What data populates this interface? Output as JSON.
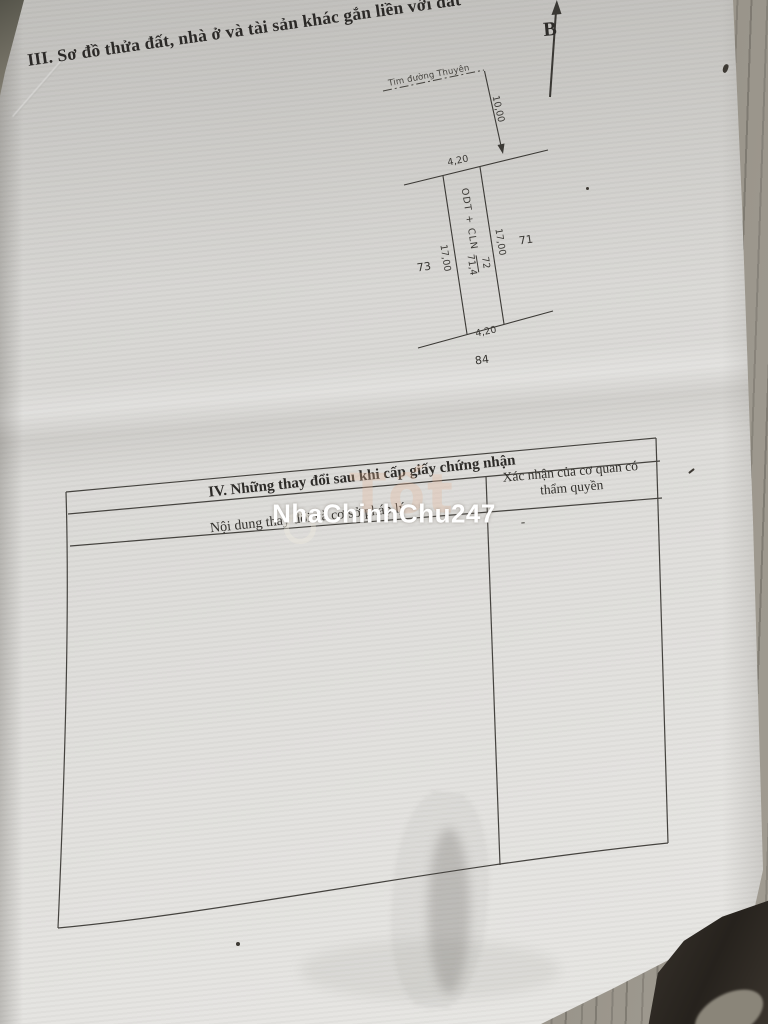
{
  "page": {
    "section3_title": "III. Sơ đồ thửa đất, nhà ở và tài sản khác gắn liền với đất"
  },
  "diagram": {
    "north_label": "B",
    "road_label": "Tim đường Thuyên",
    "dim_offset": "10,00",
    "dim_top": "4,20",
    "dim_bottom": "4,20",
    "dim_left": "17,00",
    "dim_right": "17,00",
    "land_use": "ODT + CLN",
    "parcel_number": "72",
    "parcel_area": "71,4",
    "neighbor_left": "73",
    "neighbor_right": "71",
    "neighbor_bottom": "84"
  },
  "table": {
    "section_title": "IV. Những thay đổi sau khi cấp giấy chứng nhận",
    "col_content_header": "Nội dung thay đổi và cơ sở pháp lý",
    "col_confirm_header": "Xác nhận của cơ quan có thẩm quyền",
    "body_mark": "-"
  },
  "watermark": {
    "main": "NhaChinhChu247",
    "background_logo": "Tốt"
  },
  "colors": {
    "paper": "#dddcd9",
    "ink": "#35332f",
    "table_line": "#45433f",
    "floor": "#8f8a80",
    "dark_object": "#2e2a25",
    "watermark_text": "#ffffff"
  }
}
